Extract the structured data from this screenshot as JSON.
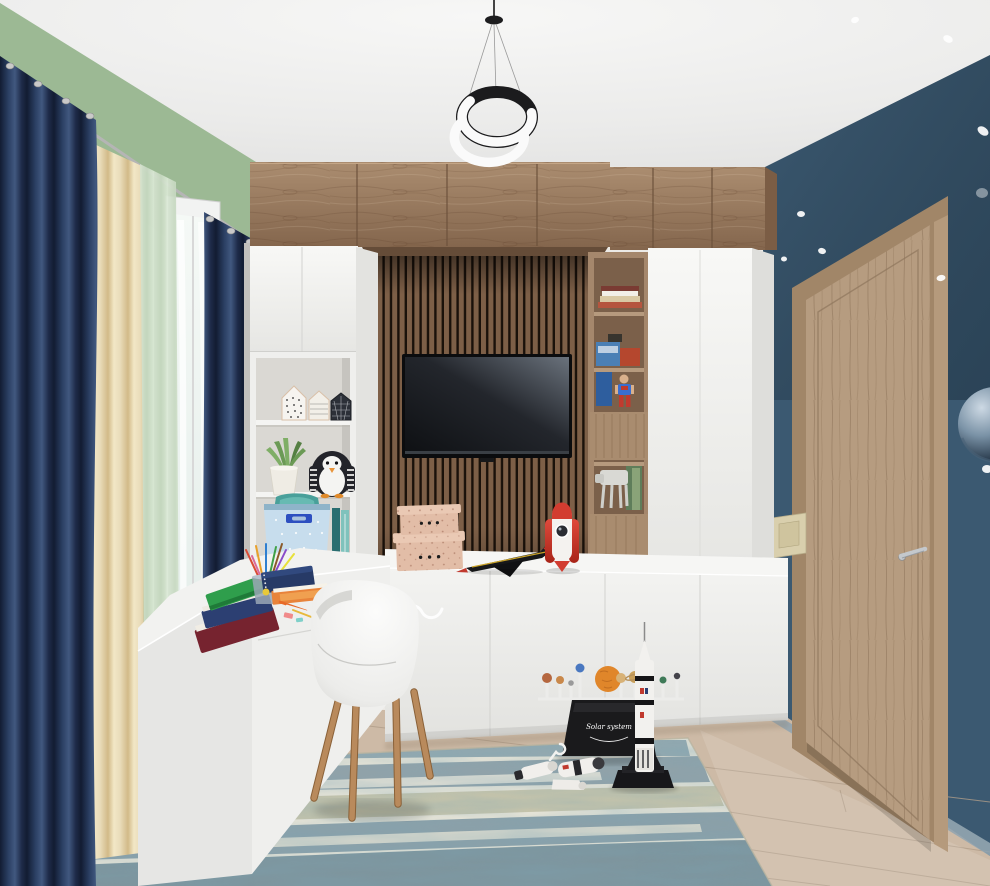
{
  "meta": {
    "description": "3D interior render of a children's bedroom / study with white-and-wood wall unit, desk, TV and space-themed toys",
    "width": 990,
    "height": 886
  },
  "labels": {
    "solar_system": "Solar system"
  },
  "palette": {
    "ceiling": "#efefee",
    "wall_left_green": "#a6c29e",
    "wall_right_blue": "#3b5971",
    "wall_blue_dark": "#2c4a60",
    "baseboard_blue": "#93a5b0",
    "floor_wood": "#cdbaa6",
    "floor_seam": "#b09d89",
    "rug_base": "#eae6d8",
    "rug_teal": "#3f6b85",
    "rug_navy": "#27506e",
    "rug_olive": "#8d8756",
    "wood_cabinet": "#9c7e63",
    "wood_cabinet_dark": "#6d523c",
    "slat_wood": "#7d5f47",
    "slat_gap": "#1a110a",
    "shelf_wood": "#a5876c",
    "white_furniture": "#f1f1ef",
    "white_furniture_shade": "#dededb",
    "desk_white": "#f2f2f0",
    "curtain_navy": "#1d2b49",
    "curtain_cream": "#e7d9b6",
    "sheer_green": "#d9e6d4",
    "window_frame": "#f2f3f2",
    "door_wood": "#b69c80",
    "door_frame": "#a18668",
    "handle_chrome": "#c4c8cc",
    "tv_screen_dark": "#121419",
    "tv_screen_light": "#6a727c",
    "rocket_red": "#d23c30",
    "sun_orange": "#e0862a",
    "basket_blue": "#c7dded",
    "basket_handle": "#2d4fc0",
    "penguin_black": "#23242a",
    "plant_green": "#6b9a55",
    "cork": "#e2bda7",
    "switch_cream": "#d9cfad",
    "star_white": "#ffffff",
    "toy_base_black": "#1a1a1c",
    "chair_leg_wood": "#b98a5c"
  },
  "objects": {
    "room": [
      "ceiling",
      "green-left-wall",
      "starry-blue-right-wall",
      "wood-floor",
      "distressed-blue-rug",
      "window-with-curtains",
      "wooden-door",
      "light-switch",
      "planet-sphere-decal",
      "ring-pendant-lamp"
    ],
    "furniture": [
      "wall-unit-wood-top-cabinets",
      "white-cabinet-column",
      "open-shelf-white",
      "slat-tv-panel",
      "wall-mounted-tv",
      "wood-open-shelf-column",
      "tall-white-cabinet",
      "white-tv-stand",
      "white-l-desk",
      "white-shell-chair"
    ],
    "decor_and_toys": [
      "house-ornaments",
      "succulent-plant",
      "penguin-plush",
      "fabric-storage-basket",
      "teal-books",
      "cork-boxes",
      "toy-jet",
      "red-rocket-toy",
      "robot-figure",
      "walker-toy",
      "book-stacks",
      "pencil-cup",
      "notebooks",
      "solar-system-model",
      "saturn-v-rocket-model",
      "spacecraft-capsule-toys"
    ]
  }
}
